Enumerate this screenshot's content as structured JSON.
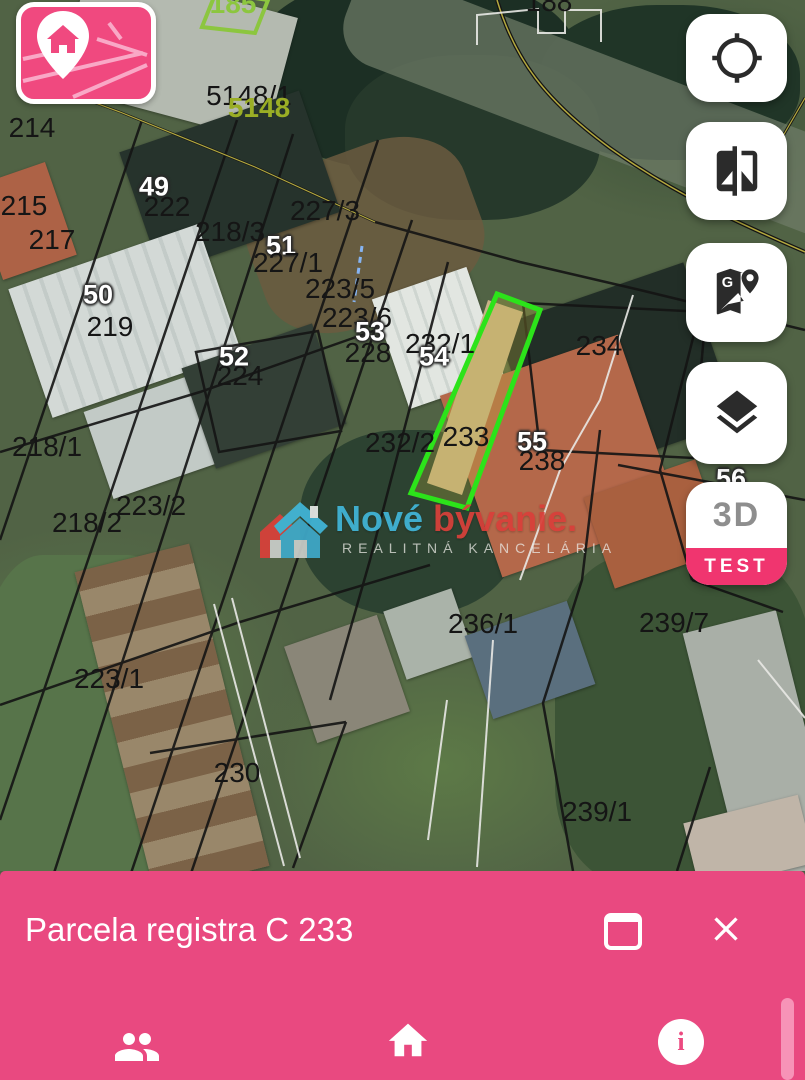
{
  "app": {
    "brand_pink": "#e94980",
    "highlight_green": "#2ce31a"
  },
  "map": {
    "labels": [
      {
        "text": "188",
        "x": 549,
        "y": 2,
        "style": "black"
      },
      {
        "text": "185",
        "x": 233,
        "y": 4,
        "style": "lime"
      },
      {
        "text": "5148/1",
        "x": 249,
        "y": 96,
        "style": "black"
      },
      {
        "text": "5148",
        "x": 259,
        "y": 108,
        "style": "olive"
      },
      {
        "text": "214",
        "x": 32,
        "y": 128,
        "style": "black"
      },
      {
        "text": "215",
        "x": 24,
        "y": 206,
        "style": "black"
      },
      {
        "text": "217",
        "x": 52,
        "y": 240,
        "style": "black"
      },
      {
        "text": "49",
        "x": 154,
        "y": 187,
        "style": "outline"
      },
      {
        "text": "222",
        "x": 167,
        "y": 207,
        "style": "black"
      },
      {
        "text": "218/3",
        "x": 230,
        "y": 232,
        "style": "black"
      },
      {
        "text": "51",
        "x": 281,
        "y": 246,
        "style": "outline"
      },
      {
        "text": "227/3",
        "x": 325,
        "y": 211,
        "style": "black"
      },
      {
        "text": "227/1",
        "x": 288,
        "y": 263,
        "style": "black"
      },
      {
        "text": "223/5",
        "x": 340,
        "y": 289,
        "style": "black"
      },
      {
        "text": "223/6",
        "x": 357,
        "y": 318,
        "style": "black"
      },
      {
        "text": "50",
        "x": 98,
        "y": 295,
        "style": "outline"
      },
      {
        "text": "219",
        "x": 110,
        "y": 327,
        "style": "black"
      },
      {
        "text": "52",
        "x": 234,
        "y": 357,
        "style": "outline"
      },
      {
        "text": "224",
        "x": 240,
        "y": 376,
        "style": "black"
      },
      {
        "text": "53",
        "x": 370,
        "y": 332,
        "style": "outline"
      },
      {
        "text": "228",
        "x": 368,
        "y": 353,
        "style": "black"
      },
      {
        "text": "232/1",
        "x": 440,
        "y": 344,
        "style": "black"
      },
      {
        "text": "54",
        "x": 434,
        "y": 357,
        "style": "outline"
      },
      {
        "text": "234",
        "x": 599,
        "y": 346,
        "style": "black"
      },
      {
        "text": "218/1",
        "x": 47,
        "y": 447,
        "style": "black"
      },
      {
        "text": "232/2",
        "x": 400,
        "y": 443,
        "style": "black"
      },
      {
        "text": "233",
        "x": 466,
        "y": 437,
        "style": "black"
      },
      {
        "text": "55",
        "x": 532,
        "y": 442,
        "style": "outline"
      },
      {
        "text": "238",
        "x": 542,
        "y": 461,
        "style": "black"
      },
      {
        "text": "56",
        "x": 731,
        "y": 479,
        "style": "outline"
      },
      {
        "text": "218/2",
        "x": 87,
        "y": 523,
        "style": "black"
      },
      {
        "text": "223/2",
        "x": 151,
        "y": 506,
        "style": "black"
      },
      {
        "text": "223/1",
        "x": 109,
        "y": 679,
        "style": "black"
      },
      {
        "text": "230",
        "x": 237,
        "y": 773,
        "style": "black"
      },
      {
        "text": "236/1",
        "x": 483,
        "y": 624,
        "style": "black"
      },
      {
        "text": "239/7",
        "x": 674,
        "y": 623,
        "style": "black"
      },
      {
        "text": "239/1",
        "x": 597,
        "y": 812,
        "style": "black"
      }
    ],
    "highlighted_parcel": "233",
    "watermark": {
      "title_part1": "Nové ",
      "title_part2": "bývanie",
      "subtitle": "REALITNÁ KANCELÁRIA",
      "color1": "#41b6d8",
      "color2": "#d9403a"
    }
  },
  "controls": {
    "locate": "my-location",
    "compare": "compare-layers",
    "gmaps": "google-maps",
    "layers": "layers",
    "three_d_label": "3D",
    "test_label": "TEST"
  },
  "panel": {
    "title": "Parcela registra C 233"
  },
  "bottom_nav": {
    "contacts": "people",
    "home": "home",
    "info_glyph": "i"
  }
}
